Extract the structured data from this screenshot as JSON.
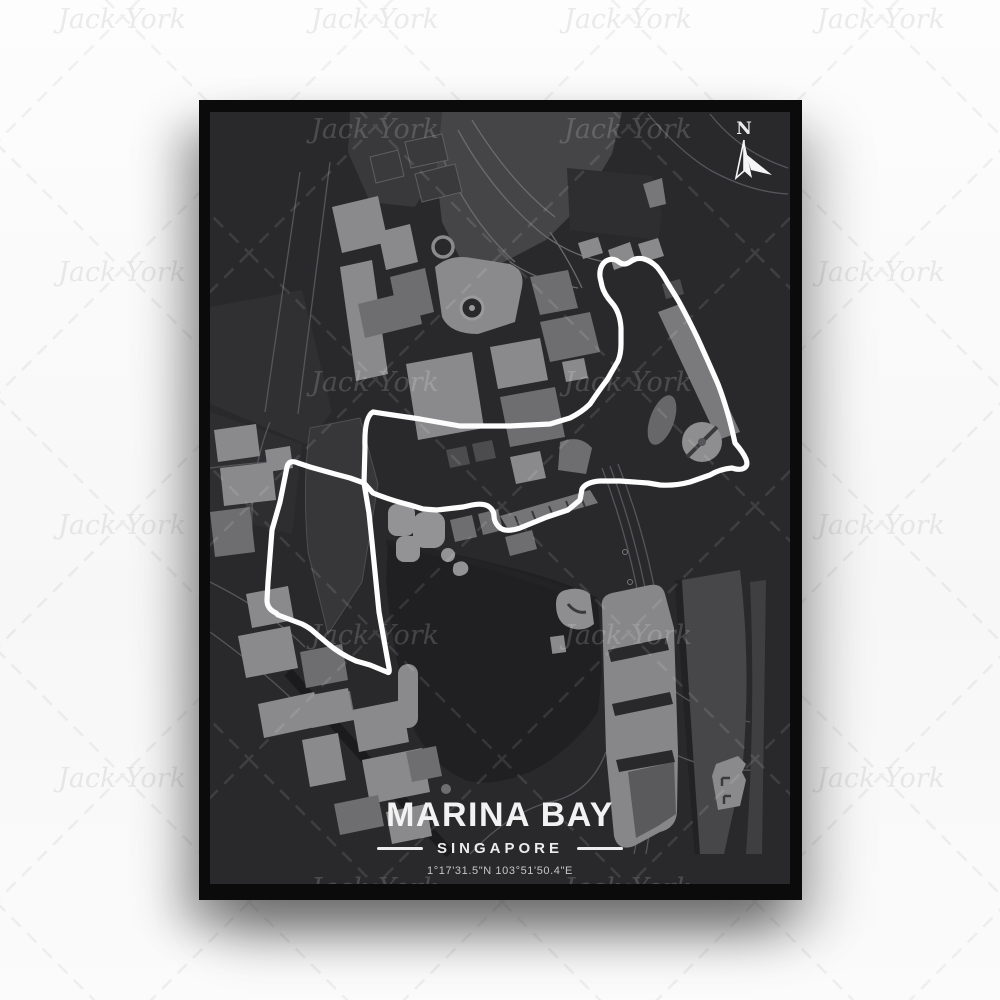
{
  "watermark": {
    "text": "Jack York"
  },
  "compass": {
    "label": "N"
  },
  "poster": {
    "title": "MARINA BAY",
    "subtitle": "SINGAPORE",
    "coordinates": "1°17'31.5\"N 103°51'50.4\"E"
  },
  "map": {
    "name": "Marina Bay street circuit map, Singapore",
    "track_color": "#fdfdfd",
    "background_color": "#29292b",
    "water_color": "#202022",
    "building_colors": [
      "#8a8a8c",
      "#6e6e70",
      "#4c4c4e"
    ]
  }
}
